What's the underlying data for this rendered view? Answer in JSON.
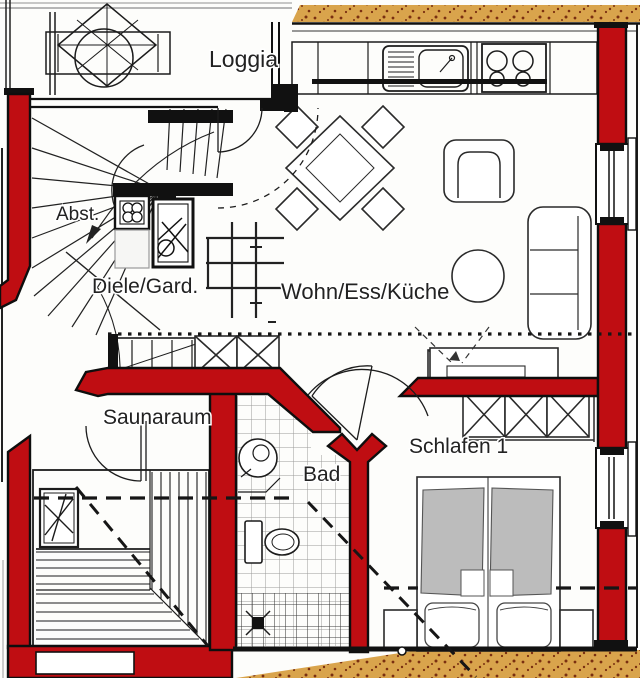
{
  "plan": {
    "labels": {
      "loggia": "Loggia",
      "abstellraum": "Abst.",
      "diele": "Diele/Gard.",
      "wohnen": "Wohn/Ess/Küche",
      "sauna": "Saunaraum",
      "bad": "Bad",
      "schlafen": "Schlafen 1"
    },
    "colors": {
      "wall": "#bf0d12",
      "band": "#d9a44c",
      "speckle": "#7a2f10",
      "duvet": "#bcbcbc",
      "line": "#141414",
      "bg": "#fdfdfb"
    }
  }
}
